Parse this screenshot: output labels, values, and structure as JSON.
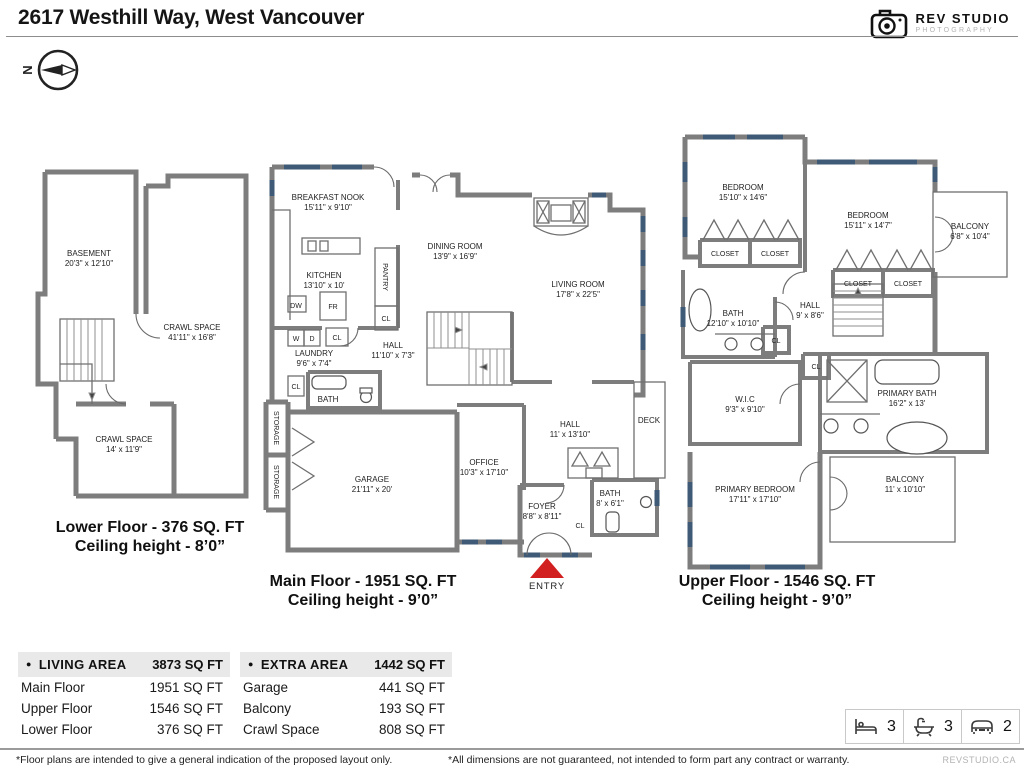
{
  "header": {
    "title": "2617 Westhill Way, West Vancouver",
    "logo": {
      "line1": "REV STUDIO",
      "line2": "PHOTOGRAPHY"
    },
    "compass": "N"
  },
  "labels": {
    "cl": "CL",
    "closet": "CLOSET",
    "storage": "STORAGE",
    "dw": "DW",
    "fr": "FR",
    "w": "W",
    "d": "D",
    "entry": "ENTRY"
  },
  "floors": {
    "lower": {
      "caption1": "Lower Floor - 376 SQ. FT",
      "caption2": "Ceiling height - 8’0”",
      "rooms": {
        "basement": {
          "name": "BASEMENT",
          "dims": "20'3\" x 12'10\""
        },
        "crawl1": {
          "name": "CRAWL SPACE",
          "dims": "41'11\" x 16'8\""
        },
        "crawl2": {
          "name": "CRAWL SPACE",
          "dims": "14' x 11'9\""
        }
      }
    },
    "main": {
      "caption1": "Main Floor - 1951 SQ. FT",
      "caption2": "Ceiling height - 9’0”",
      "rooms": {
        "nook": {
          "name": "BREAKFAST NOOK",
          "dims": "15'11\" x 9'10\""
        },
        "kitchen": {
          "name": "KITCHEN",
          "dims": "13'10\" x 10'"
        },
        "pantry": {
          "name": "PANTRY"
        },
        "dining": {
          "name": "DINING ROOM",
          "dims": "13'9\" x 16'9\""
        },
        "living": {
          "name": "LIVING ROOM",
          "dims": "17'8\" x 22'5\""
        },
        "hall1": {
          "name": "HALL",
          "dims": "11'10\" x 7'3\""
        },
        "laundry": {
          "name": "LAUNDRY",
          "dims": "9'6\" x 7'4\""
        },
        "bath1": {
          "name": "BATH"
        },
        "garage": {
          "name": "GARAGE",
          "dims": "21'11\" x 20'"
        },
        "office": {
          "name": "OFFICE",
          "dims": "10'3\" x 17'10\""
        },
        "hall2": {
          "name": "HALL",
          "dims": "11' x 13'10\""
        },
        "deck": {
          "name": "DECK"
        },
        "foyer": {
          "name": "FOYER",
          "dims": "8'8\" x 8'11\""
        },
        "bath2": {
          "name": "BATH",
          "dims": "8' x 6'1\""
        }
      }
    },
    "upper": {
      "caption1": "Upper Floor - 1546 SQ. FT",
      "caption2": "Ceiling height - 9’0”",
      "rooms": {
        "bed1": {
          "name": "BEDROOM",
          "dims": "15'10\" x 14'6\""
        },
        "bed2": {
          "name": "BEDROOM",
          "dims": "15'11\" x 14'7\""
        },
        "balc1": {
          "name": "BALCONY",
          "dims": "6'8\" x 10'4\""
        },
        "bath": {
          "name": "BATH",
          "dims": "12'10\" x 10'10\""
        },
        "hall": {
          "name": "HALL",
          "dims": "9' x 8'6\""
        },
        "wic": {
          "name": "W.I.C",
          "dims": "9'3\" x 9'10\""
        },
        "pbath": {
          "name": "PRIMARY BATH",
          "dims": "16'2\" x 13'"
        },
        "pbed": {
          "name": "PRIMARY BEDROOM",
          "dims": "17'11\" x 17'10\""
        },
        "balc2": {
          "name": "BALCONY",
          "dims": "11' x 10'10\""
        }
      }
    }
  },
  "tables": {
    "living": {
      "header": "LIVING AREA",
      "total": "3873 SQ FT",
      "rows": [
        {
          "label": "Main Floor",
          "value": "1951 SQ FT"
        },
        {
          "label": "Upper Floor",
          "value": "1546 SQ FT"
        },
        {
          "label": "Lower Floor",
          "value": "376 SQ FT"
        }
      ]
    },
    "extra": {
      "header": "EXTRA AREA",
      "total": "1442 SQ FT",
      "rows": [
        {
          "label": "Garage",
          "value": "441 SQ FT"
        },
        {
          "label": "Balcony",
          "value": "193 SQ FT"
        },
        {
          "label": "Crawl Space",
          "value": "808 SQ FT"
        }
      ]
    }
  },
  "stats": {
    "beds": "3",
    "baths": "3",
    "cars": "2"
  },
  "footer": {
    "left": "*Floor plans are intended to give a general indication of the proposed layout only.",
    "center": "*All dimensions are not guaranteed, not intended to form part any contract or warranty.",
    "right": "REVSTUDIO.CA"
  },
  "colors": {
    "wall": "#7d7d7d",
    "window": "#3e5a76",
    "entry_arrow": "#d22020"
  }
}
